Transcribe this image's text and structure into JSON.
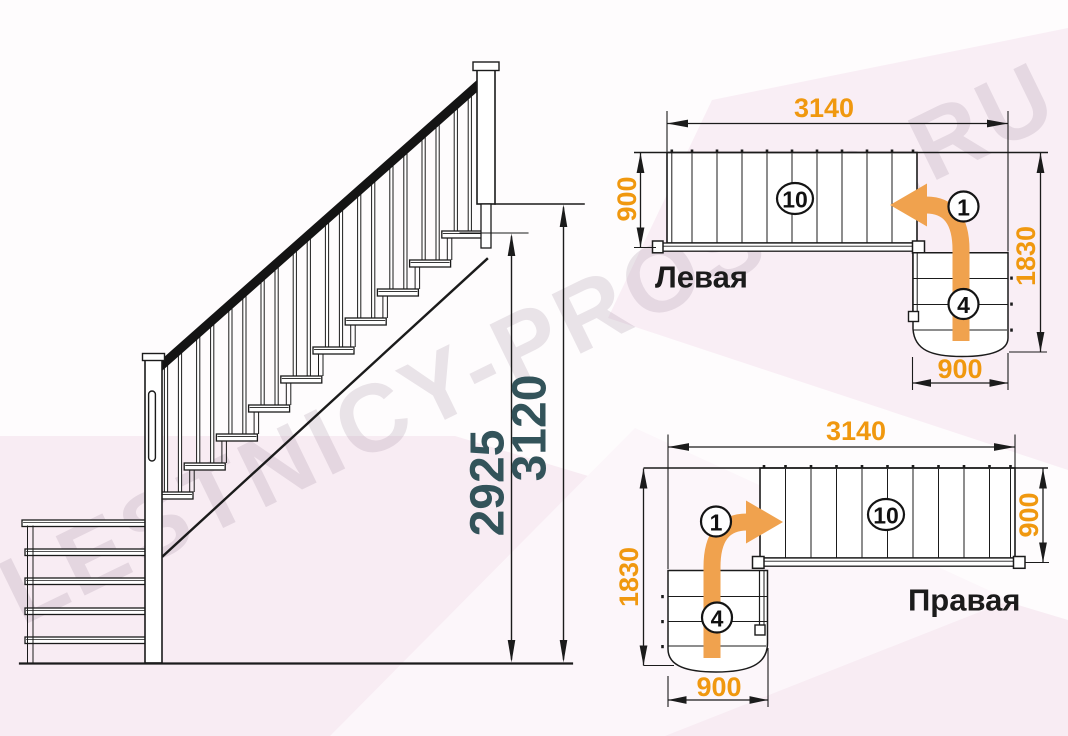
{
  "watermark": "LESTNICY-PROSTO.RU",
  "colors": {
    "plan_dimension": "#F0980F",
    "elevation_dimension": "#33535A",
    "turn_arrow": "#F0A24E",
    "line": "#1B1B1B",
    "background_tint": "#F8ECF3"
  },
  "elevation": {
    "dim_to_landing": "2925",
    "dim_total": "3120"
  },
  "plan_left": {
    "title": "Левая",
    "dim_length": "3140",
    "dim_flight_width": "900",
    "dim_turn_depth": "1830",
    "dim_lower_width": "900",
    "count_straight": "10",
    "count_first": "1",
    "count_lower": "4"
  },
  "plan_right": {
    "title": "Правая",
    "dim_length": "3140",
    "dim_flight_width": "900",
    "dim_turn_depth": "1830",
    "dim_lower_width": "900",
    "count_straight": "10",
    "count_first": "1",
    "count_lower": "4"
  }
}
